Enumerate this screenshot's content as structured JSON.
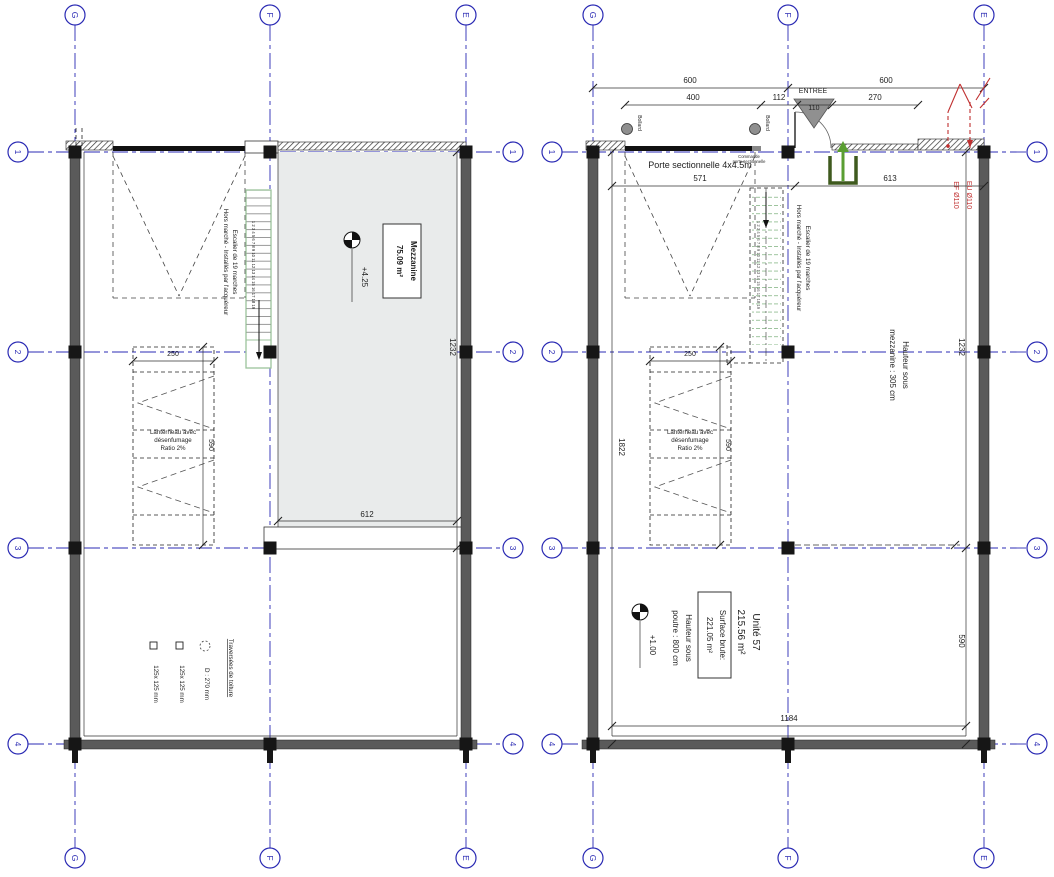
{
  "grid": {
    "cols": [
      "G",
      "F",
      "E"
    ],
    "rows": [
      "1",
      "2",
      "3",
      "4"
    ]
  },
  "shared": {
    "stair_line1": "Escalier de 19 marches",
    "stair_line2": "Hors marché - Installés par l'acquéreur",
    "stair_numbers": "1 2 3 4 5 6 7 8 9 10 11 12 13 14 15 16 17 18 19",
    "lanterneau_line1": "Lanterneau avec",
    "lanterneau_line2": "désenfumage",
    "lanterneau_line3": "Ratio 2%",
    "lanterneau_width": "250",
    "lanterneau_height": "590"
  },
  "left_plan": {
    "room_name": "Mezzanine",
    "room_area": "75.09 m²",
    "level": "+4.25",
    "dim_height": "1232",
    "dim_edge": "612",
    "legend_title": "Traversées de toiture",
    "legend_item1": "D : 270 mm",
    "legend_item2": "125x 125 mm",
    "legend_item3": "125x 125 mm"
  },
  "right_plan": {
    "dim_600_left": "600",
    "dim_600_right": "600",
    "dim_400": "400",
    "dim_112": "112",
    "dim_110": "110",
    "dim_270": "270",
    "entree_label": "ENTREE",
    "bollard_label": "Bollard",
    "door_label": "Porte sectionnelle 4x4.5m",
    "dim_571": "571",
    "dim_613": "613",
    "commande_line1": "Commande",
    "commande_line2": "porte sectionnelle",
    "red_eu": "EU Ø110",
    "red_ef": "EF Ø110",
    "hauteur_mezzanine_line1": "Hauteur sous",
    "hauteur_mezzanine_line2": "mezzanine : 305 cm",
    "dim_height_upper": "1232",
    "dim_total": "1822",
    "dim_width": "1184",
    "dim_height_lower": "590",
    "unit_name": "Unité 57",
    "unit_area": "215.56 m²",
    "surface_line1": "Surface brute:",
    "surface_line2": "221.05 m²",
    "hauteur_poutre_line1": "Hauteur sous",
    "hauteur_poutre_line2": "poutre : 800 cm",
    "level": "+1.00"
  },
  "colors": {
    "grid_blue": "#2b2bb4",
    "annotation_red": "#c03030",
    "stair_green": "#9cc39c",
    "entry_green": "#4f7a28",
    "wall_gray": "#5a5a5a",
    "mezzanine_fill": "#e9ebeb"
  }
}
